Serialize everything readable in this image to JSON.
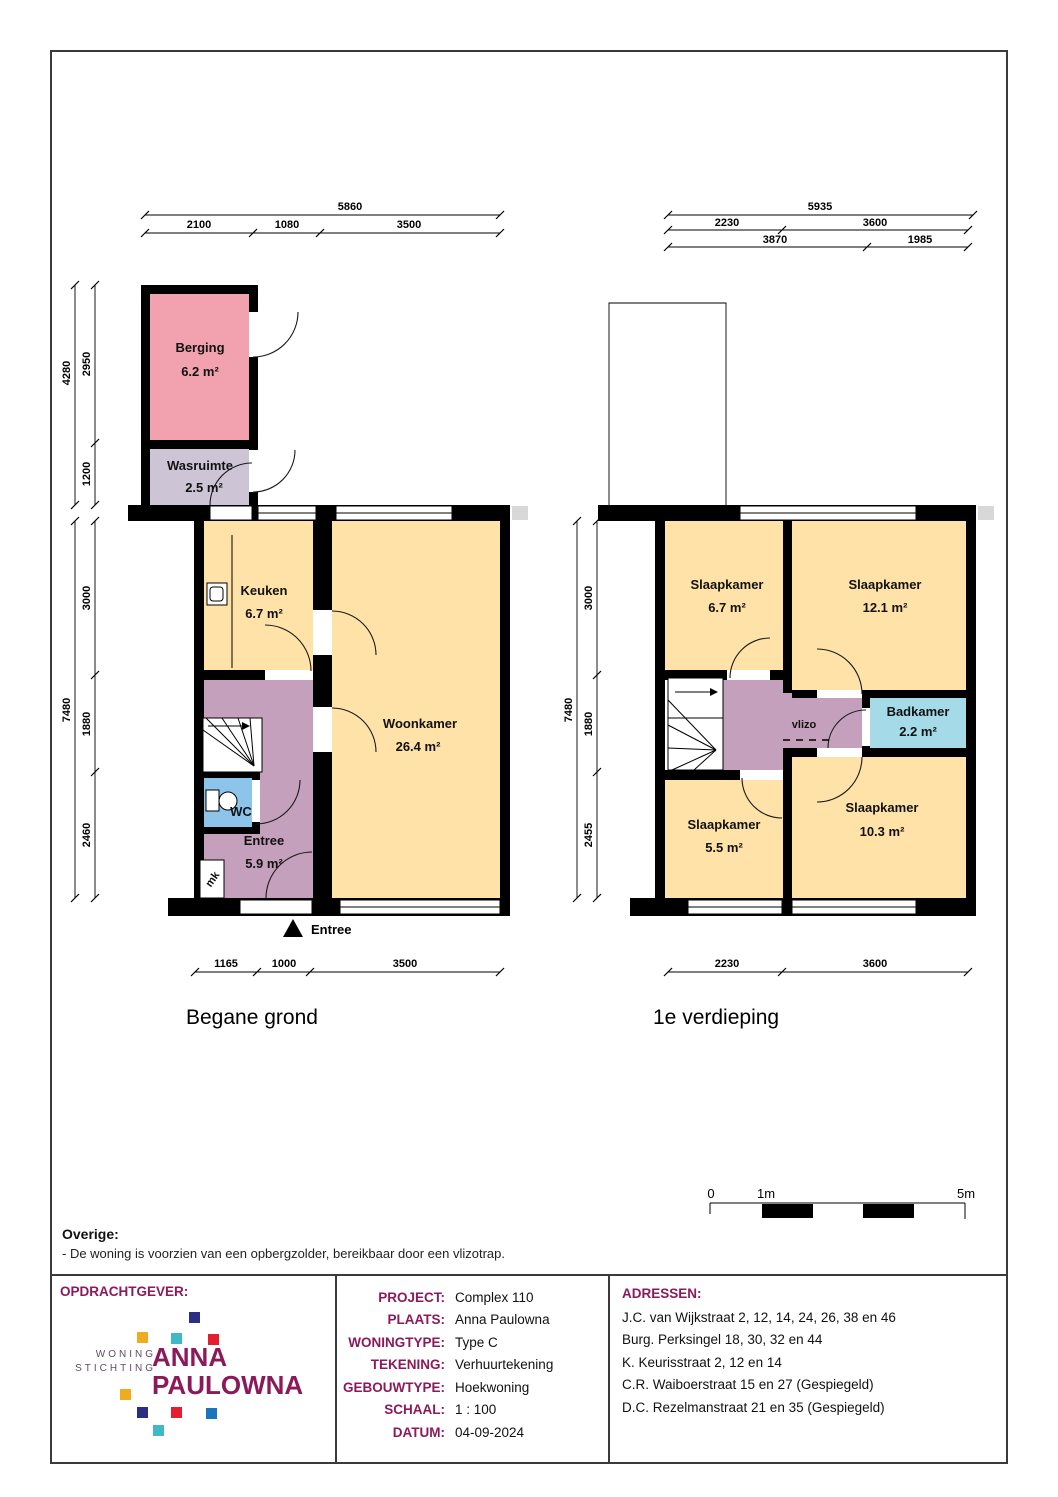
{
  "ground_floor": {
    "title": "Begane grond",
    "entrance_label": "Entree",
    "rooms": {
      "berging": {
        "name": "Berging",
        "area": "6.2 m²"
      },
      "wasruimte": {
        "name": "Wasruimte",
        "area": "2.5 m²"
      },
      "keuken": {
        "name": "Keuken",
        "area": "6.7 m²"
      },
      "woonkamer": {
        "name": "Woonkamer",
        "area": "26.4 m²"
      },
      "wc": {
        "name": "WC"
      },
      "entree": {
        "name": "Entree",
        "area": "5.9 m²"
      },
      "mk": {
        "name": "mk"
      }
    },
    "dims": {
      "top_total": "5860",
      "top": [
        "2100",
        "1080",
        "3500"
      ],
      "left_outer": [
        "4280",
        "7480"
      ],
      "left": [
        "2950",
        "1200",
        "3000",
        "1880",
        "2460"
      ],
      "bottom": [
        "1165",
        "1000",
        "3500"
      ]
    }
  },
  "first_floor": {
    "title": "1e verdieping",
    "rooms": {
      "slaapkamer1": {
        "name": "Slaapkamer",
        "area": "6.7 m²"
      },
      "slaapkamer2": {
        "name": "Slaapkamer",
        "area": "12.1 m²"
      },
      "badkamer": {
        "name": "Badkamer",
        "area": "2.2 m²"
      },
      "vlizo": {
        "name": "vlizo"
      },
      "slaapkamer3": {
        "name": "Slaapkamer",
        "area": "5.5 m²"
      },
      "slaapkamer4": {
        "name": "Slaapkamer",
        "area": "10.3 m²"
      }
    },
    "dims": {
      "top_total": "5935",
      "top": [
        "2230",
        "3600"
      ],
      "top_row3": [
        "3870",
        "1985"
      ],
      "left_outer": "7480",
      "left": [
        "3000",
        "1880",
        "2455"
      ],
      "bottom": [
        "2230",
        "3600"
      ]
    }
  },
  "scale_bar": {
    "labels": [
      "0",
      "1m",
      "5m"
    ]
  },
  "notes": {
    "header": "Overige:",
    "items": [
      "- De woning is voorzien van een opbergzolder, bereikbaar door een vlizotrap."
    ]
  },
  "title_block": {
    "opdrachtgever_label": "OPDRACHTGEVER:",
    "logo": {
      "line1": "WONING",
      "line2": "STICHTING",
      "name1": "ANNA",
      "name2": "PAULOWNA"
    },
    "fields": [
      {
        "label": "PROJECT:",
        "value": "Complex 110"
      },
      {
        "label": "PLAATS:",
        "value": "Anna Paulowna"
      },
      {
        "label": "WONINGTYPE:",
        "value": "Type C"
      },
      {
        "label": "TEKENING:",
        "value": "Verhuurtekening"
      },
      {
        "label": "GEBOUWTYPE:",
        "value": "Hoekwoning"
      },
      {
        "label": "SCHAAL:",
        "value": "1 : 100"
      },
      {
        "label": "DATUM:",
        "value": "04-09-2024"
      }
    ],
    "adressen_label": "ADRESSEN:",
    "adressen": [
      "J.C. van Wijkstraat 2, 12, 14, 24, 26, 38 en 46",
      "Burg. Perksingel 18, 30, 32 en 44",
      "K. Keurisstraat 2, 12 en 14",
      "C.R. Waiboerstraat 15 en 27 (Gespiegeld)",
      "D.C. Rezelmanstraat 21 en 35 (Gespiegeld)"
    ]
  },
  "colors": {
    "room_yellow": "#ffe2a8",
    "berging_pink": "#f2a2ae",
    "wasruimte_lavender": "#cdc4d6",
    "hall_mauve": "#c4a0bc",
    "wc_blue": "#8cc5e9",
    "badkamer_cyan": "#a5dbe8",
    "wall_black": "#000000",
    "brand_magenta": "#8c1a5b",
    "logo_squares": [
      "#2b2e83",
      "#efac1e",
      "#3fb9c6",
      "#e41e2e",
      "#1b74bc"
    ]
  }
}
